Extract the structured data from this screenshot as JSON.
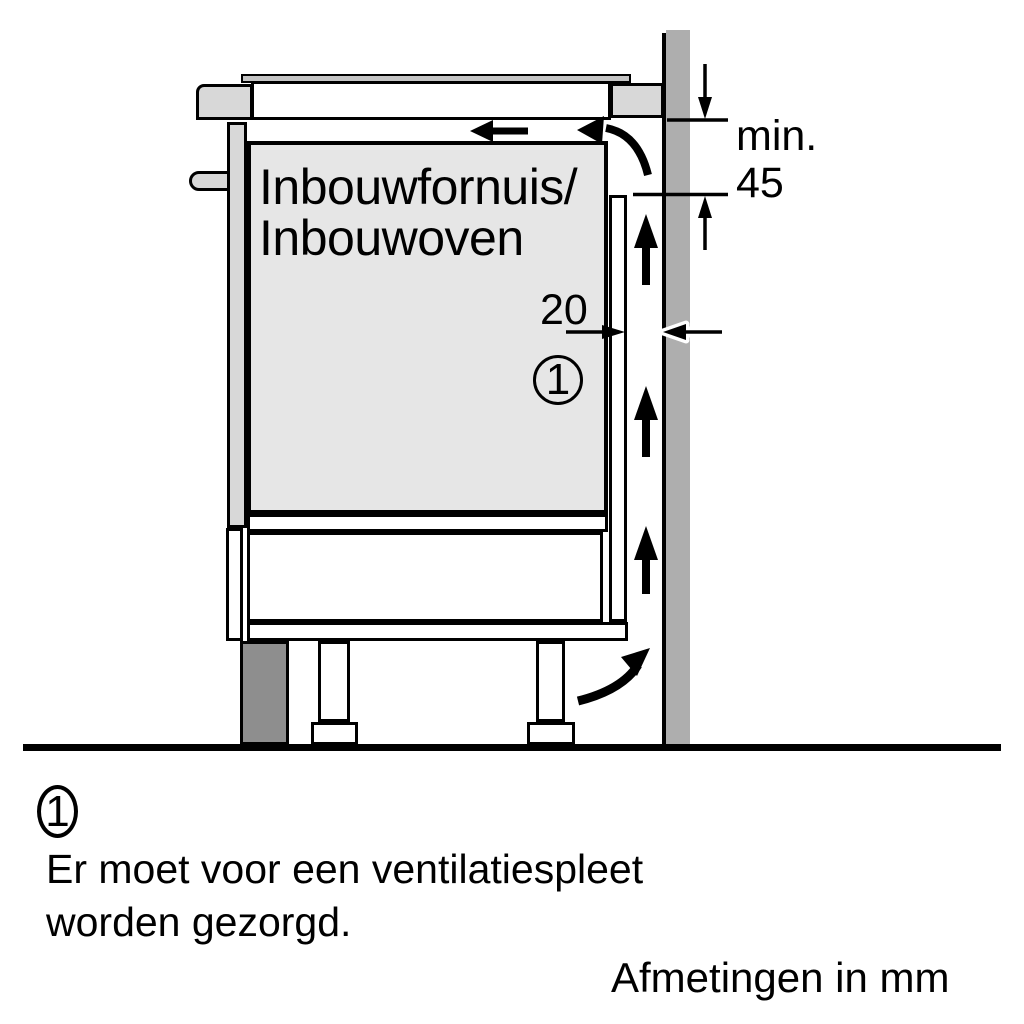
{
  "diagram": {
    "appliance_label": {
      "line1": "Inbouwfornuis/",
      "line2": "Inbouwoven"
    },
    "min_gap": {
      "line1": "min.",
      "line2": "45"
    },
    "side_gap": {
      "value": "20"
    },
    "callout_number": "1"
  },
  "legend": {
    "number": "1",
    "line1": "Er moet voor een ventilatiespleet",
    "line2": "worden gezorgd."
  },
  "footer": {
    "units_note": "Afmetingen in mm"
  },
  "colors": {
    "background": "#ffffff",
    "line": "#000000",
    "wall": "#aeaeae",
    "plinth": "#8e8e8e",
    "cabinet_fill": "#e6e6e6",
    "worktop_fill": "#d8d8d8",
    "hob_glass": "#c4c4c4"
  }
}
